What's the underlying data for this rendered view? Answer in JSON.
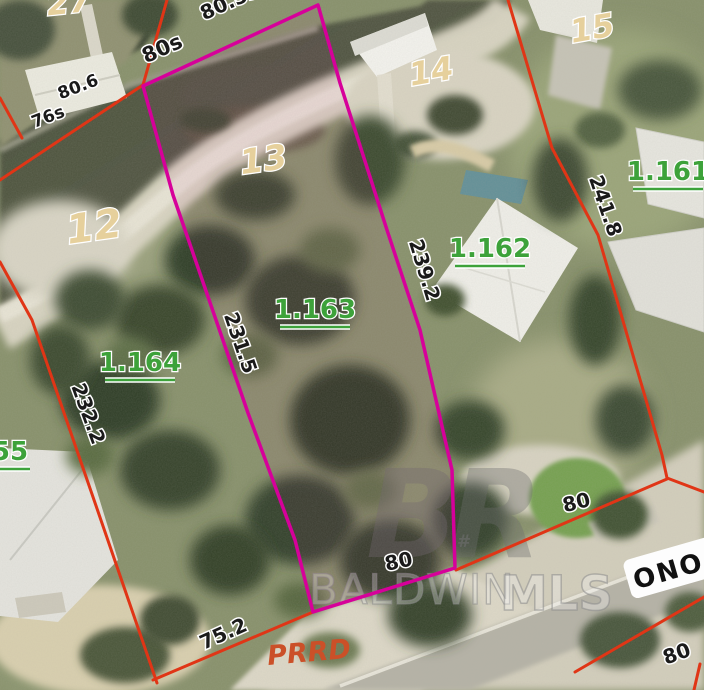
{
  "map": {
    "watermark": {
      "logo": "BR",
      "symbol": "#",
      "name": "BALDWIN",
      "suffix": "MLS"
    },
    "streets": {
      "prrd": "PRRD",
      "ono": "ONO"
    },
    "lot_numbers": {
      "lot27": "27",
      "lot12": "12",
      "lot13": "13",
      "lot14": "14",
      "lot15": "15"
    },
    "parcel_ids": {
      "p1161": "1.161",
      "p1162": "1.162",
      "p1163": "1.163",
      "p1164": "1.164",
      "p55": "55"
    },
    "dimensions": {
      "top_cut": "80.5s",
      "top": "80s",
      "d80_6": "80.6",
      "d76s": "76s",
      "west": "231.5",
      "east": "239.2",
      "right": "241.8",
      "left": "232.2",
      "bottom": "75.2",
      "frontage_center": "80",
      "frontage_right": "80",
      "across_road": "80"
    },
    "colors": {
      "boundary_red": "#e03516",
      "highlight_magenta": "#d6009a",
      "parcel_id_green": "#3da23a",
      "lot_number_cream": "#e6d09c",
      "street_label_orange": "#cb5028",
      "dimension_text": "#1a1a1a",
      "watermark_gray": "#6e6e6e"
    }
  }
}
